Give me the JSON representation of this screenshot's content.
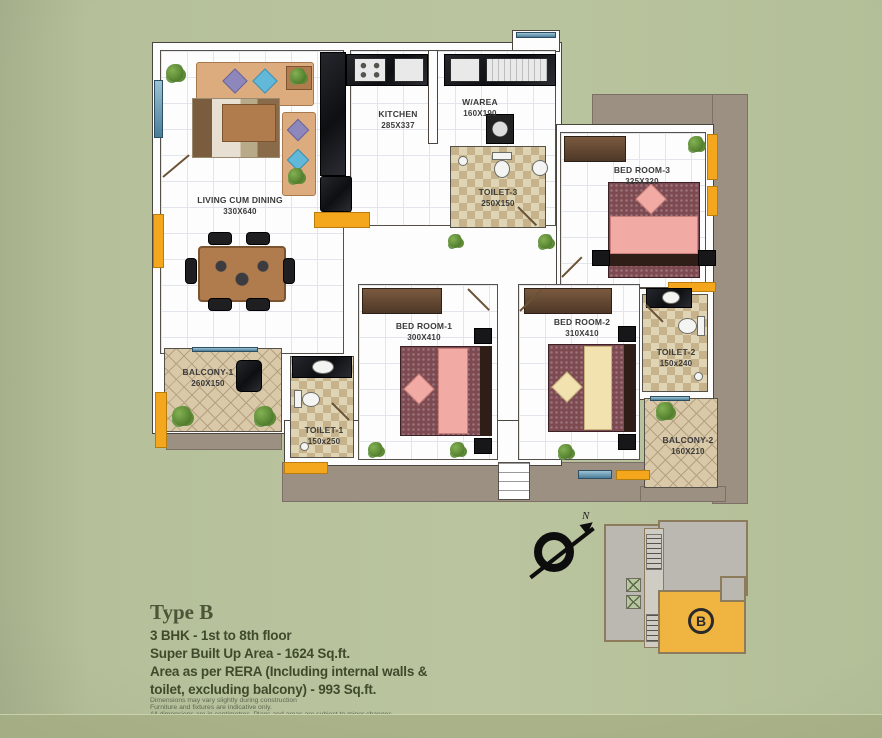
{
  "plan": {
    "rooms": {
      "living": {
        "name": "LIVING CUM DINING",
        "dims": "330X640"
      },
      "kitchen": {
        "name": "KITCHEN",
        "dims": "285X337"
      },
      "warea": {
        "name": "W/AREA",
        "dims": "160X190"
      },
      "toilet3": {
        "name": "TOILET-3",
        "dims": "250X150"
      },
      "bedroom3": {
        "name": "BED ROOM-3",
        "dims": "325X320"
      },
      "bedroom1": {
        "name": "BED ROOM-1",
        "dims": "300X410"
      },
      "bedroom2": {
        "name": "BED ROOM-2",
        "dims": "310X410"
      },
      "toilet1": {
        "name": "TOILET-1",
        "dims": "150x250"
      },
      "toilet2": {
        "name": "TOILET-2",
        "dims": "150x240"
      },
      "balcony1": {
        "name": "BALCONY-1",
        "dims": "260X150"
      },
      "balcony2": {
        "name": "BALCONY-2",
        "dims": "160X210"
      }
    },
    "compass": {
      "north_label": "N"
    },
    "keyplan": {
      "unit_label": "B"
    }
  },
  "info": {
    "title": "Type B",
    "lines": [
      "3 BHK - 1st to 8th floor",
      "Super Built Up Area - 1624 Sq.ft.",
      "Area as per RERA (Including internal walls &",
      "toilet, excluding balcony) - 993 Sq.ft."
    ],
    "disclaimers": [
      "Dimensions may vary slightly during construction",
      "Furniture and fixtures are indicative only.",
      "All dimensions are in centimetres. Plans and areas are subject to minor changes."
    ]
  },
  "colors": {
    "background": "#b5c09a",
    "accent_yellow": "#f4a71d",
    "wall_shadow": "#9c9083",
    "keyplan_unit_yellow": "#f0b541"
  }
}
